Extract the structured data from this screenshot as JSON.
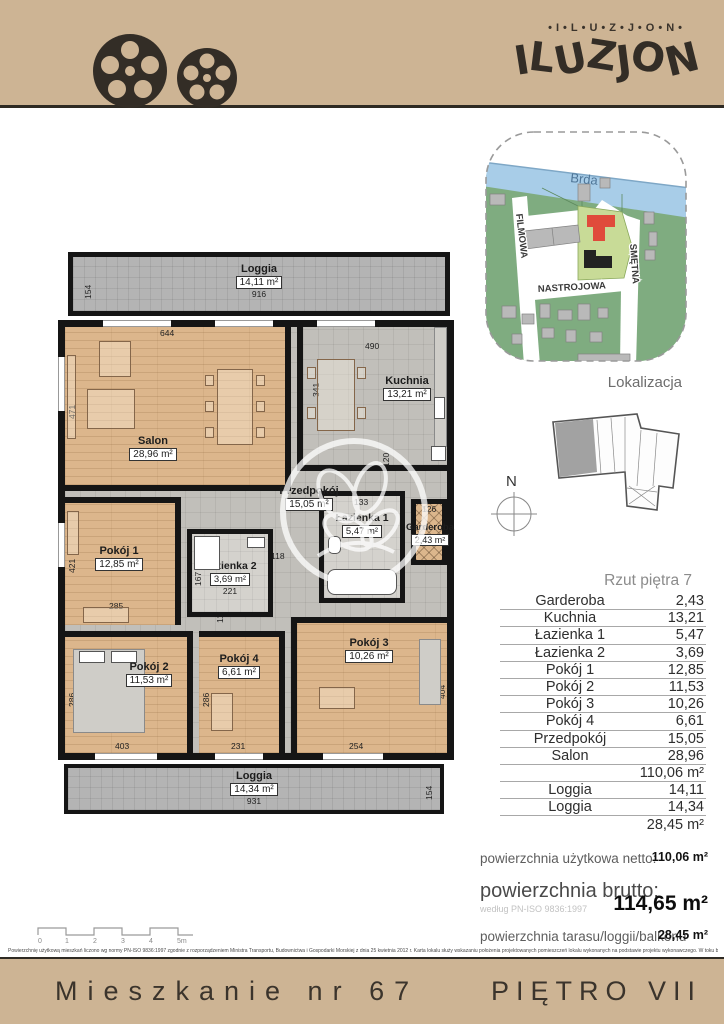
{
  "colors": {
    "header_bg": "#cdb494",
    "brand_dark": "#332d26",
    "plan_wood": "#dcb68c",
    "plan_tile": "#c1bfba",
    "loggia_gray": "#b4b4b4",
    "map_green": "#7fac80",
    "map_river": "#a8cde8",
    "map_parcel": "#c8db97",
    "map_building_red": "#e04b3b",
    "map_building_black": "#222222"
  },
  "header": {
    "brand_small": "•I•L•U•Z•J•O•N•",
    "logo_letters": [
      "I",
      "L",
      "U",
      "Z",
      "J",
      "O",
      "N"
    ]
  },
  "map": {
    "river_label": "Brda",
    "street_filmowa": "FILMOWA",
    "street_nastrojowa": "NASTROJOWA",
    "street_smetna": "SMĘTNA",
    "caption": "Lokalizacja"
  },
  "compass": {
    "label": "N"
  },
  "floor_table": {
    "title": "Rzut piętra 7",
    "rows": [
      {
        "label": "Garderoba",
        "value": "2,43"
      },
      {
        "label": "Kuchnia",
        "value": "13,21"
      },
      {
        "label": "Łazienka 1",
        "value": "5,47"
      },
      {
        "label": "Łazienka 2",
        "value": "3,69"
      },
      {
        "label": "Pokój 1",
        "value": "12,85"
      },
      {
        "label": "Pokój 2",
        "value": "11,53"
      },
      {
        "label": "Pokój 3",
        "value": "10,26"
      },
      {
        "label": "Pokój 4",
        "value": "6,61"
      },
      {
        "label": "Przedpokój",
        "value": "15,05"
      },
      {
        "label": "Salon",
        "value": "28,96"
      }
    ],
    "usable_total": "110,06 m²",
    "loggia_rows": [
      {
        "label": "Loggia",
        "value": "14,11"
      },
      {
        "label": "Loggia",
        "value": "14,34"
      }
    ],
    "outdoor_total": "28,45 m²"
  },
  "summary": {
    "netto_label": "powierzchnia użytkowa netto:",
    "netto_value": "110,06 m²",
    "brutto_label": "powierzchnia brutto:",
    "brutto_note": "według PN-ISO 9836:1997",
    "brutto_value": "114,65 m²",
    "taras_label": "powierzchnia tarasu/loggii/balkonu",
    "taras_value": "28,45 m²"
  },
  "plan": {
    "loggia_top": {
      "name": "Loggia",
      "area": "14,11 m²",
      "width": "916",
      "depth": "154"
    },
    "salon": {
      "name": "Salon",
      "area": "28,96 m²",
      "width": "644",
      "height": "471"
    },
    "kuchnia": {
      "name": "Kuchnia",
      "area": "13,21 m²",
      "width": "490",
      "h_left": "341",
      "h_right": "269"
    },
    "przedpokoj": {
      "name": "Przedpokój",
      "area": "15,05 m²"
    },
    "pokoj1": {
      "name": "Pokój 1",
      "area": "12,85 m²",
      "height": "421",
      "width": "285"
    },
    "lazienka2": {
      "name": "Łazienka 2",
      "area": "3,69 m²",
      "height": "167",
      "width": "221"
    },
    "lazienka1": {
      "name": "Łazienka 1",
      "area": "5,47 m²",
      "width": "133"
    },
    "garderoba": {
      "name": "Garderoba",
      "area": "2,43 m²",
      "width": "126"
    },
    "pokoj2": {
      "name": "Pokój 2",
      "area": "11,53 m²",
      "height": "286",
      "width": "403"
    },
    "pokoj4": {
      "name": "Pokój 4",
      "area": "6,61 m²",
      "height": "286",
      "width": "231"
    },
    "pokoj3": {
      "name": "Pokój 3",
      "area": "10,26 m²",
      "height": "404",
      "width": "254"
    },
    "loggia_bottom": {
      "name": "Loggia",
      "area": "14,34 m²",
      "width": "931",
      "depth": "154"
    },
    "hall_dim_h": "118",
    "hall_dim_v": "118",
    "ward_dim_v": "120"
  },
  "scalebar": {
    "labels": [
      "0",
      "1",
      "2",
      "3",
      "4",
      "5m"
    ]
  },
  "legal": "Powierzchnię użytkową mieszkań liczono wg normy PN-ISO 9836:1997 zgodnie z rozporządzeniem Ministra Transportu, Budownictwa i Gospodarki Morskiej z dnia 25 kwietnia 2012 r. Karta lokalu służy wskazaniu położenia projektowanych pomieszczeń lokalu wykonanych na podstawie projektu wykonawczego. W toku budowy mogą wystąpić niewielkie zmiany w stosunku do informacji zawartych w karcie katalogowej.",
  "footer": {
    "left": "Mieszkanie nr 67",
    "right": "PIĘTRO VII"
  }
}
